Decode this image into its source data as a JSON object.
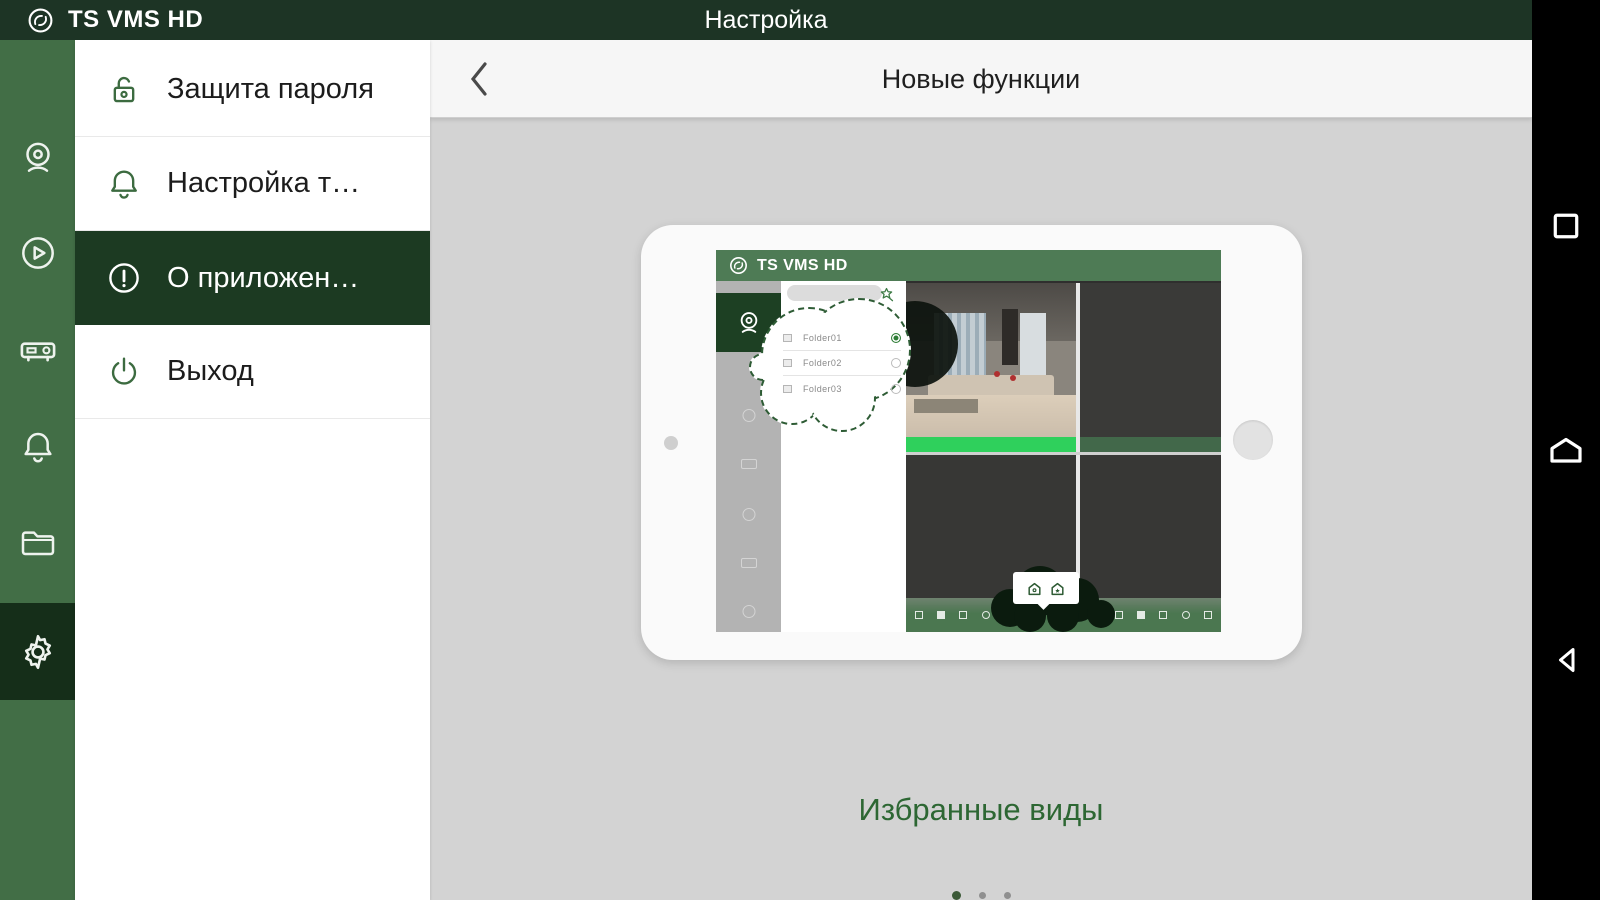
{
  "app": {
    "title": "TS VMS HD",
    "screen_title": "Настройка"
  },
  "colors": {
    "topbar": "#1d3425",
    "sidebar": "#426e46",
    "sidebar_selected": "#152e19",
    "menu_selected": "#1c3a22",
    "mini_topbar": "#4e7b55",
    "highlight_green": "#2fd05c",
    "caption_green": "#2d6733",
    "content_bg": "#d3d3d3",
    "navbar_bg": "#000000"
  },
  "sidebar": {
    "items": [
      {
        "icon": "live-view-camera-icon",
        "selected": false
      },
      {
        "icon": "playback-icon",
        "selected": false
      },
      {
        "icon": "device-dvr-icon",
        "selected": false
      },
      {
        "icon": "alarm-bell-icon",
        "selected": false
      },
      {
        "icon": "file-folder-icon",
        "selected": false
      },
      {
        "icon": "settings-gear-icon",
        "selected": true
      }
    ]
  },
  "menu": {
    "items": [
      {
        "label": "Защита пароля",
        "icon": "lock-open-icon",
        "selected": false
      },
      {
        "label": "Настройка т…",
        "icon": "bell-icon",
        "selected": false
      },
      {
        "label": "О приложен…",
        "icon": "info-exclamation-icon",
        "selected": true
      },
      {
        "label": "Выход",
        "icon": "power-icon",
        "selected": false
      }
    ]
  },
  "detail": {
    "title": "Новые функции"
  },
  "tutorial": {
    "device_screen": {
      "app_title": "TS VMS HD",
      "folders": [
        {
          "name": "Folder01",
          "selected": true
        },
        {
          "name": "Folder02",
          "selected": false
        },
        {
          "name": "Folder03",
          "selected": false
        }
      ]
    },
    "caption": "Избранные виды",
    "page_dots": {
      "count": 3,
      "active_index": 0
    }
  },
  "navbar": {
    "buttons": [
      "recents",
      "home",
      "back"
    ]
  }
}
